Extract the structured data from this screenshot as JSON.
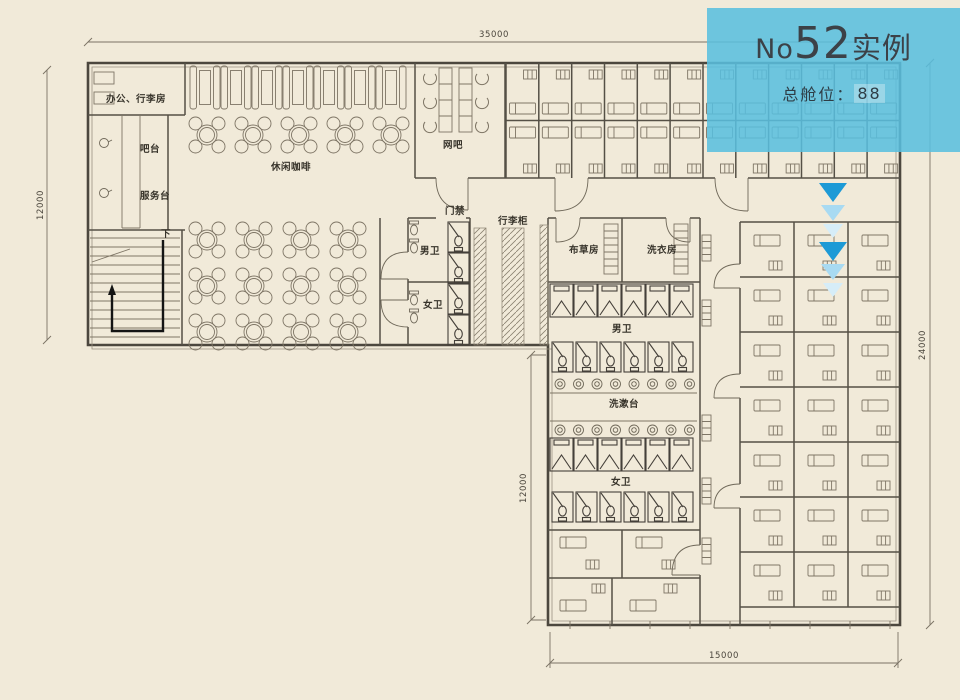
{
  "banner": {
    "bg_color": "#58bfdf",
    "title_prefix": "No",
    "title_number": "52",
    "title_suffix": "实例",
    "capacity_label": "总舱位：",
    "capacity_value": "88"
  },
  "plan": {
    "labels": {
      "office": "办公、行李房",
      "bar_counter": "吧台",
      "service_desk": "服务台",
      "leisure_cafe": "休闲咖啡",
      "internet_bar": "网吧",
      "access_gate": "门禁",
      "luggage_lockers": "行李柜",
      "mens_wc_small": "男卫",
      "womens_wc_small": "女卫",
      "linen_room": "布草房",
      "laundry_room": "洗衣房",
      "mens_wc": "男卫",
      "wash_counter": "洗漱台",
      "womens_wc": "女卫",
      "stairs_down": "下"
    },
    "dimensions": {
      "top": "35000",
      "left": "12000",
      "right": "24000",
      "inner": "12000",
      "bottom": "15000"
    },
    "arrow_colors": {
      "dark": "#1d9ad6",
      "medium": "#a8daf2",
      "light": "#d6edf8"
    }
  }
}
